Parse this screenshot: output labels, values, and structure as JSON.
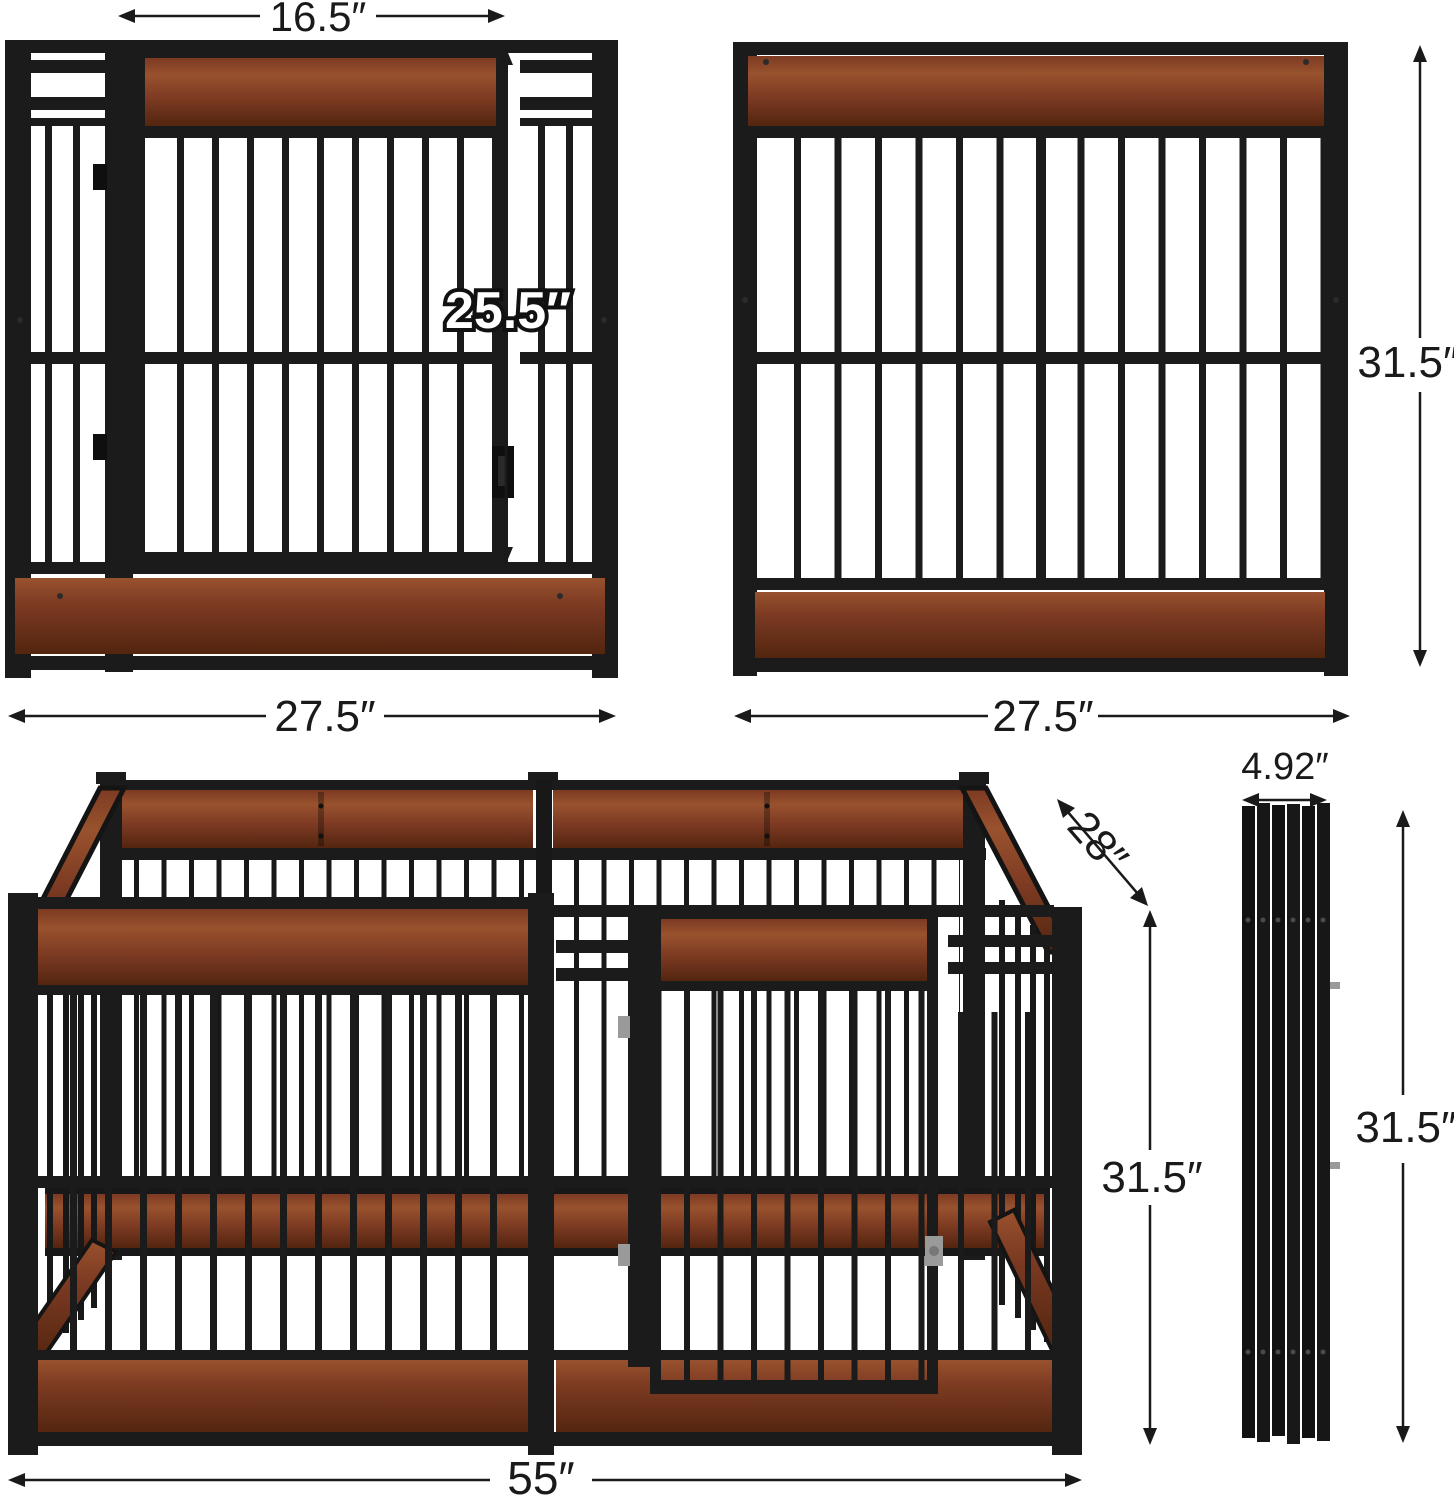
{
  "diagram": {
    "kind": "product-dimensions",
    "product": "wooden dog crate playpen panels"
  },
  "colors": {
    "metal": "#1b1b1b",
    "metal_dark": "#0f0f0f",
    "wood": "#7c3a22",
    "wood_light": "#99522e",
    "wood_dark": "#53250f",
    "silver": "#9a9a9a",
    "dim_text": "#1a1a1a",
    "background": "#ffffff"
  },
  "dimensions": {
    "door_width": "16.5″",
    "door_height": "25.5″",
    "front_panel_width": "27.5″",
    "side_panel_width": "27.5″",
    "side_panel_height": "31.5″",
    "pen_depth": "28″",
    "folded_thickness": "4.92″",
    "pen_height": "31.5″",
    "folded_height": "31.5″",
    "pen_width": "55″"
  }
}
